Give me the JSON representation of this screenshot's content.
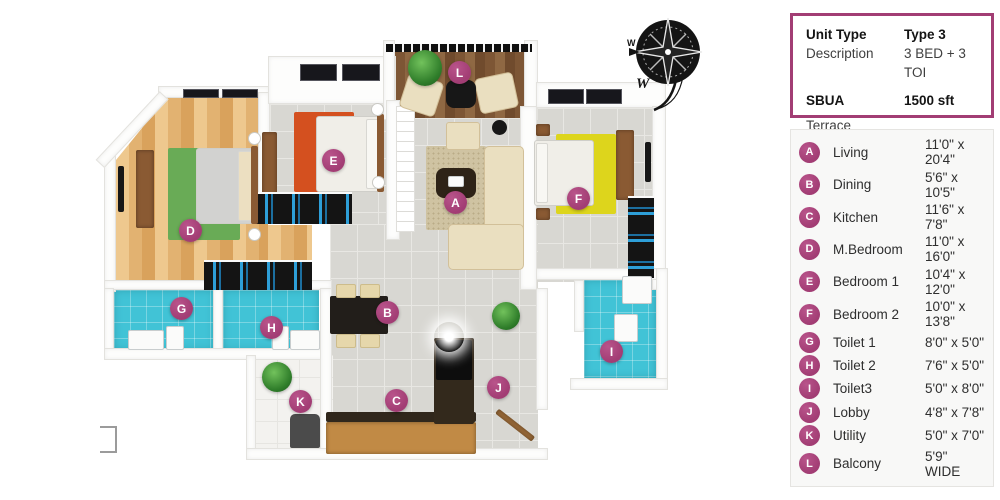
{
  "info_panel": {
    "rows": [
      {
        "label": "Unit Type",
        "value": "Type 3",
        "bold": true
      },
      {
        "label": "Description",
        "value": "3 BED + 3 TOI",
        "bold": false
      },
      {
        "label": "SBUA",
        "value": "1500 sft",
        "bold": true
      },
      {
        "label": "Terrace",
        "value": "",
        "bold": false
      }
    ]
  },
  "legend": {
    "items": [
      {
        "letter": "A",
        "name": "Living",
        "size": "11'0\" x 20'4\""
      },
      {
        "letter": "B",
        "name": "Dining",
        "size": "5'6\" x 10'5\""
      },
      {
        "letter": "C",
        "name": "Kitchen",
        "size": "11'6\" x 7'8\""
      },
      {
        "letter": "D",
        "name": "M.Bedroom",
        "size": "11'0\" x 16'0\""
      },
      {
        "letter": "E",
        "name": "Bedroom 1",
        "size": "10'4\" x 12'0\""
      },
      {
        "letter": "F",
        "name": "Bedroom 2",
        "size": "10'0\" x 13'8\""
      },
      {
        "letter": "G",
        "name": "Toilet 1",
        "size": "8'0\" x 5'0\""
      },
      {
        "letter": "H",
        "name": "Toilet 2",
        "size": "7'6\" x 5'0\""
      },
      {
        "letter": "I",
        "name": "Toilet3",
        "size": "5'0\" x 8'0\""
      },
      {
        "letter": "J",
        "name": "Lobby",
        "size": "4'8\" x 7'8\""
      },
      {
        "letter": "K",
        "name": "Utility",
        "size": "5'0\" x 7'0\""
      },
      {
        "letter": "L",
        "name": "Balcony",
        "size": "5'9\" WIDE"
      }
    ]
  },
  "plan": {
    "markers": [
      {
        "letter": "A",
        "x": 455,
        "y": 202
      },
      {
        "letter": "B",
        "x": 387,
        "y": 312
      },
      {
        "letter": "C",
        "x": 396,
        "y": 400
      },
      {
        "letter": "D",
        "x": 190,
        "y": 230
      },
      {
        "letter": "E",
        "x": 333,
        "y": 160
      },
      {
        "letter": "F",
        "x": 578,
        "y": 198
      },
      {
        "letter": "G",
        "x": 181,
        "y": 308
      },
      {
        "letter": "H",
        "x": 271,
        "y": 327
      },
      {
        "letter": "I",
        "x": 611,
        "y": 351
      },
      {
        "letter": "J",
        "x": 498,
        "y": 387
      },
      {
        "letter": "K",
        "x": 300,
        "y": 401
      },
      {
        "letter": "L",
        "x": 459,
        "y": 72
      }
    ]
  },
  "compass": {
    "direction_labels": [
      "W",
      "W"
    ]
  },
  "colors": {
    "accent": "#a23d74",
    "panel_border": "#9a3a6b",
    "bath_tile": "#41c3d6",
    "rug_master": "#69ab56",
    "rug_bedroom1": "#d4501f",
    "rug_bedroom2": "#ddd51c",
    "wood_floor": "#e2b271",
    "deck_wood": "#7d5635"
  }
}
